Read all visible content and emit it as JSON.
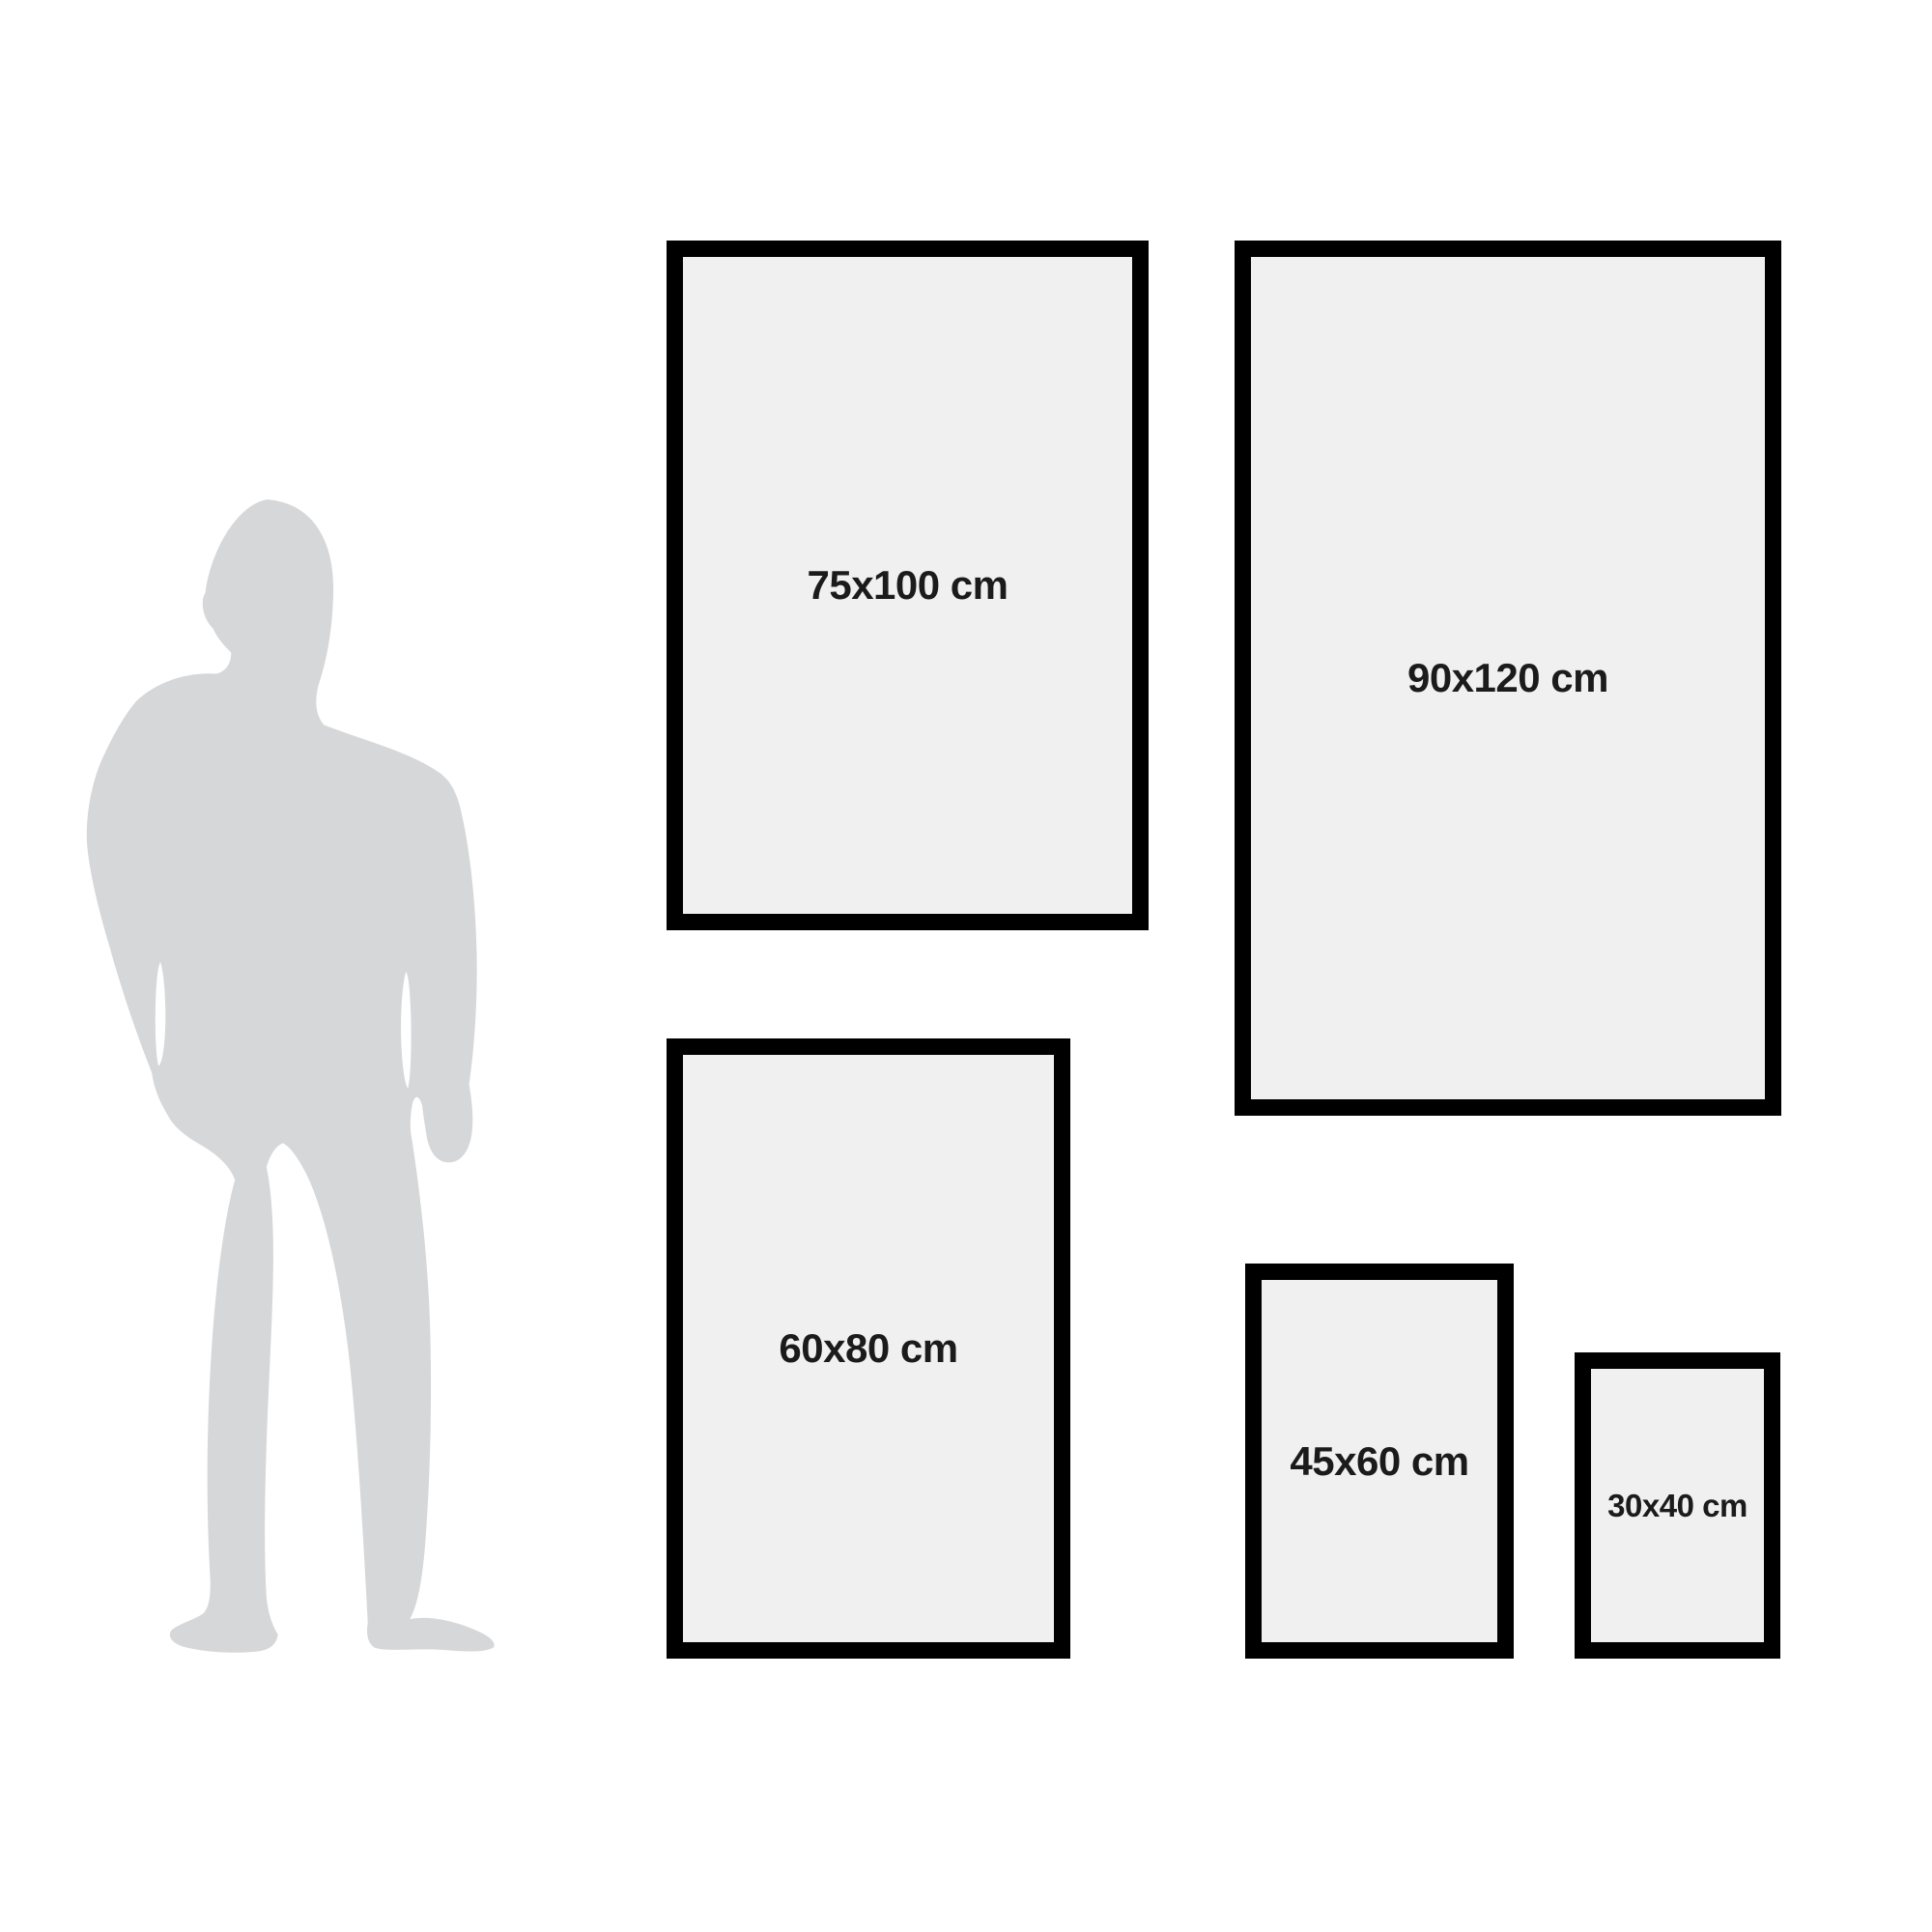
{
  "figure": {
    "icon": "man-silhouette-icon"
  },
  "frames": [
    {
      "id": "75x100",
      "label": "75x100 cm"
    },
    {
      "id": "90x120",
      "label": "90x120 cm"
    },
    {
      "id": "60x80",
      "label": "60x80 cm"
    },
    {
      "id": "45x60",
      "label": "45x60 cm"
    },
    {
      "id": "30x40",
      "label": "30x40 cm"
    }
  ],
  "colors": {
    "background": "#ffffff",
    "frame_border": "#000000",
    "frame_fill": "#f0f0f0",
    "label_text": "#1b1b1b",
    "silhouette": "#d6d7d9"
  }
}
